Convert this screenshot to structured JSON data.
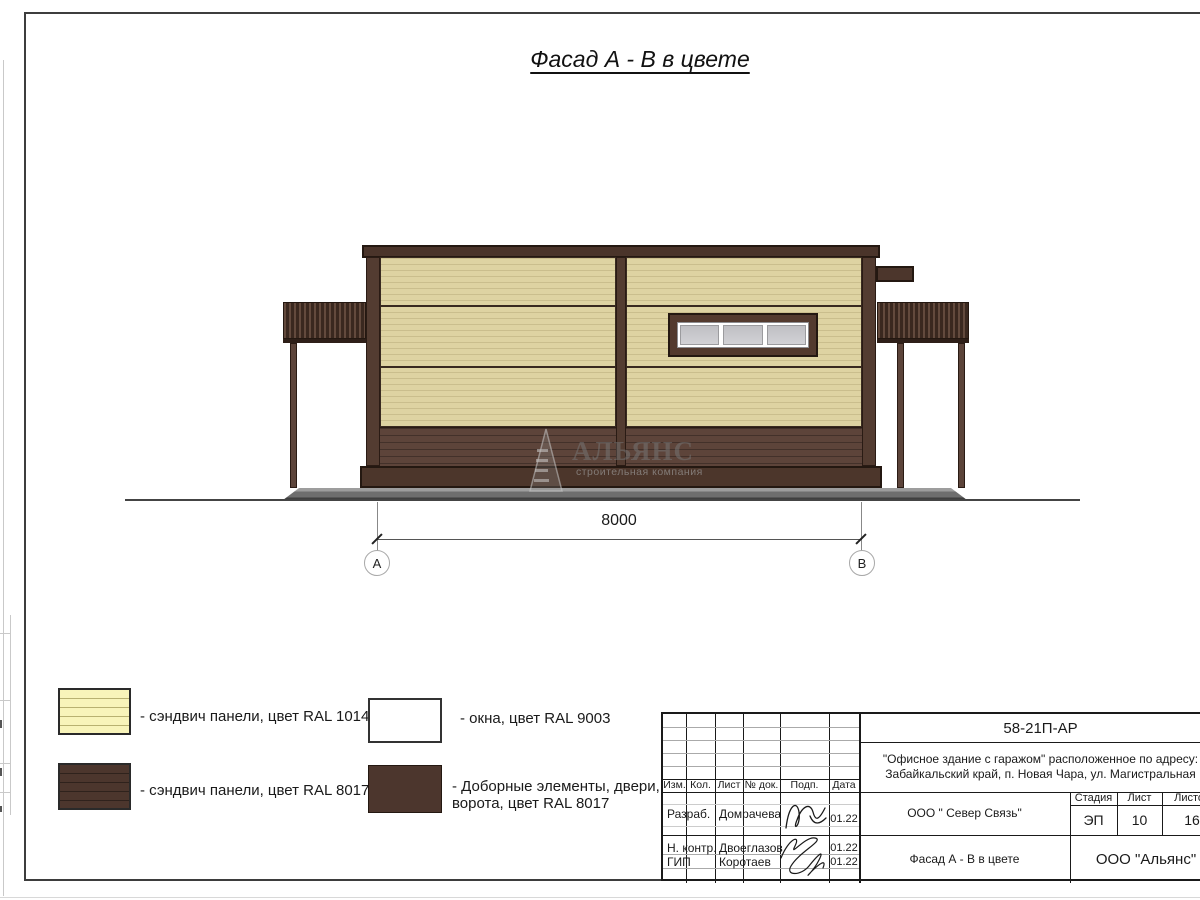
{
  "sheet": {
    "title": "Фасад А - В в цвете"
  },
  "drawing": {
    "dimension_label": "8000",
    "axis_left": "А",
    "axis_right": "В",
    "watermark_title": "АЛЬЯНС",
    "watermark_subtitle": "строительная компания",
    "colors": {
      "panel_ral1014": "#ded3a2",
      "trim_ral8017": "#4c362d",
      "window_ral9003": "#ffffff",
      "window_pane": "#c9c9cd",
      "ground": "#808080"
    }
  },
  "legend": {
    "items": [
      {
        "label": "- сэндвич панели, цвет RAL 1014",
        "color": "#f8f4ba"
      },
      {
        "label": "- сэндвич панели, цвет RAL 8017",
        "color": "#4c362d"
      },
      {
        "label": "- окна, цвет RAL 9003",
        "color": "#ffffff"
      },
      {
        "label": "- Доборные элементы, двери,\nворота, цвет RAL 8017",
        "color": "#4c362d"
      }
    ]
  },
  "title_block": {
    "doc_number": "58-21П-АР",
    "project_line1": "\"Офисное здание с гаражом\" расположенное по адресу:",
    "project_line2": "Забайкальский край, п. Новая Чара, ул. Магистральная",
    "organization": "ООО \" Север Связь\"",
    "sheet_name": "Фасад А - В в цвете",
    "company": "ООО \"Альянс\"",
    "stage_label": "Стадия",
    "stage_value": "ЭП",
    "sheet_label": "Лист",
    "sheet_value": "10",
    "sheets_label": "Листов",
    "sheets_value": "16",
    "columns": {
      "izm": "Изм.",
      "kol": "Кол.",
      "list": "Лист",
      "doc": "№ док.",
      "podp": "Подп.",
      "data": "Дата"
    },
    "rows": [
      {
        "role": "Разраб.",
        "name": "Домрачева",
        "date": "01.22"
      },
      {
        "role": "Н. контр.",
        "name": "Двоеглазов",
        "date": "01.22"
      },
      {
        "role": "ГИП",
        "name": "Коротаев",
        "date": "01.22"
      }
    ]
  }
}
